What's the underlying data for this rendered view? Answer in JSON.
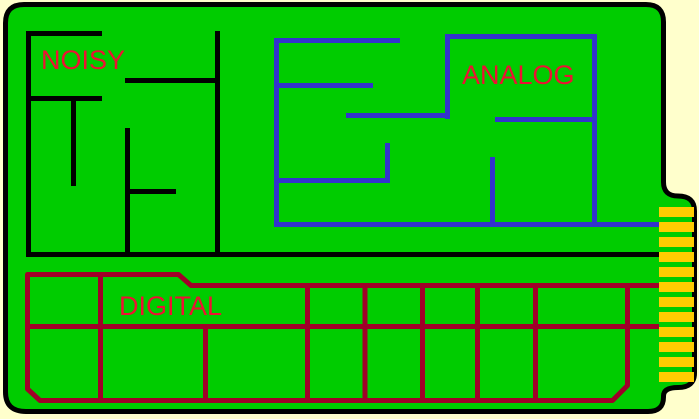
{
  "background_color": "#FFFFCC",
  "board": {
    "color": "#00CC00",
    "outline_color": "#000000"
  },
  "regions": [
    {
      "id": "noisy",
      "label": "NOISY",
      "label_color": "#EE1133",
      "trace_color": "#000000"
    },
    {
      "id": "analog",
      "label": "ANALOG",
      "label_color": "#EE1133",
      "trace_color": "#3333CC"
    },
    {
      "id": "digital",
      "label": "DIGITAL",
      "label_color": "#EE1133",
      "trace_color": "#A00028"
    }
  ],
  "connector": {
    "finger_count": 12,
    "finger_color": "#FFCC00"
  }
}
